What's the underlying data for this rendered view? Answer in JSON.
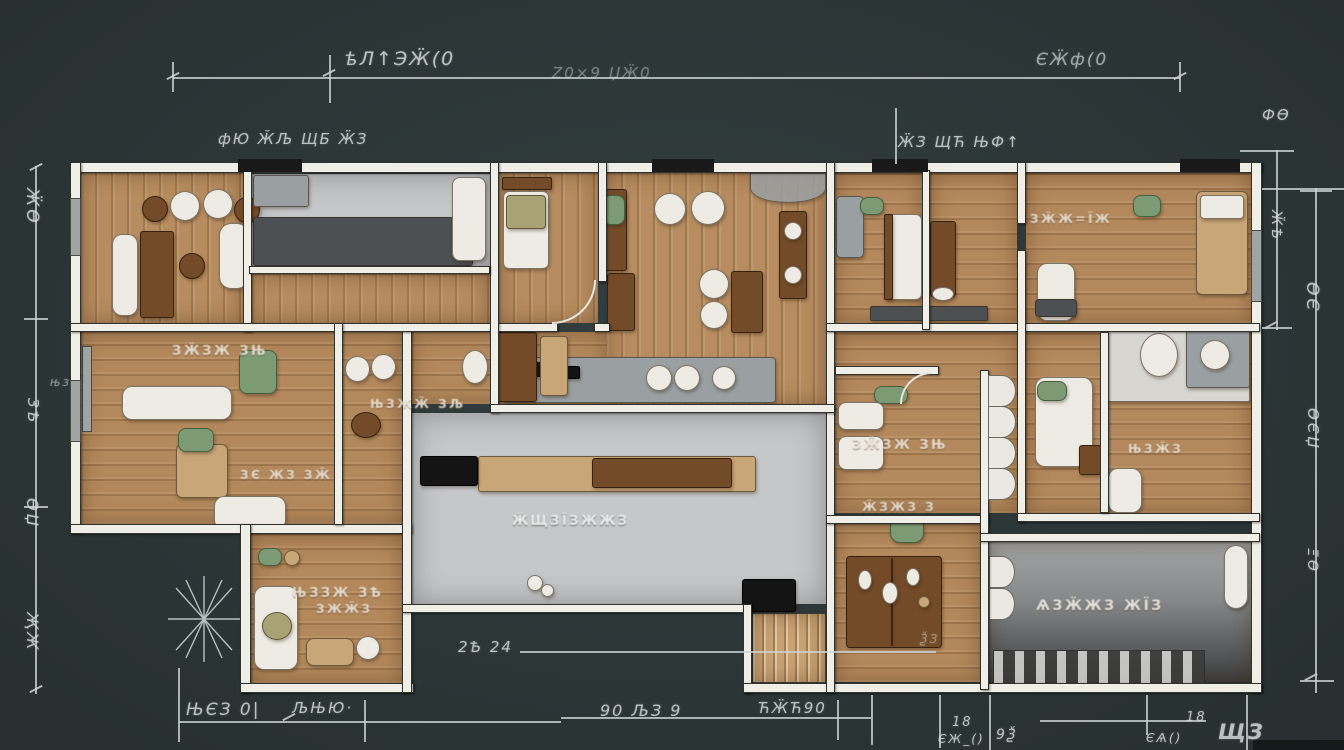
{
  "scene": {
    "kind": "architectural floor plan blueprint, top-down render, dark slate background"
  },
  "palette": {
    "background": "#2c3637",
    "wall": "#efeee7",
    "wall_outline": "#33332e",
    "wood_floor": "#b68b5f",
    "tile_floor": "#c6c7c8",
    "dark_counter": "#4d5052",
    "dark_wood": "#744b28",
    "dimension_ink": "#ccd5d4",
    "label_ink": "#fcf9f2",
    "plant_green": "#7c9b74",
    "black_fixture": "#141414"
  },
  "dimensions": {
    "top": {
      "main_left": "ѣЛ↑ЭӜ(0",
      "main_mid": "Z0×9 ЏӜ0",
      "main_right": "ЄӜф(0",
      "annot_left": "фЮ ӁЉ ЩБ ӜЗ",
      "annot_right": "ӜЗ ЩЋ ЊФ↑"
    },
    "left": {
      "l1": "ӜѲ",
      "l2": "ЊЗ",
      "l3": "ЗѢ",
      "l4": "ѲЏ",
      "l5": "ҖЖ"
    },
    "right": {
      "r1": "ФѲ",
      "r2": "ӁѢ",
      "r3": "ѲЄ",
      "r4": "ѲЄЏ",
      "r5": "ΞѲ",
      "r6": "ЩЗ"
    },
    "bottom": {
      "b1": "ЊЄЗ 0|",
      "b2": "ЉЊЮ·",
      "b3": "90 ЉЗ 9",
      "b4": "ЋӜЋ90",
      "b5": "18",
      "b6": "ЄЖ_()",
      "b7": "9Ѯ",
      "b8": "18",
      "b9": "ЄѦ()",
      "b10": "2Ѣ 24",
      "b11": "ѮЗ"
    }
  },
  "rooms": {
    "labels": [
      "ЗӜЗЖ ЗЊ",
      "ЊЗЖӜ ЗЉ",
      "ЗЄ ЖЗ ЗӜ",
      "ЊЗЗЖ ЗѢ",
      "ЗЖӜЗ",
      "ӜЩЗЇЗЖЖЗ",
      "ЗӜЗЖ ЗЊ",
      "ӜЗЖЗ З",
      "ЊЗӜЗ",
      "ЗӜЖ=ЇЖ",
      "ѦЗӜЖЗ ЖЇЗ"
    ]
  }
}
